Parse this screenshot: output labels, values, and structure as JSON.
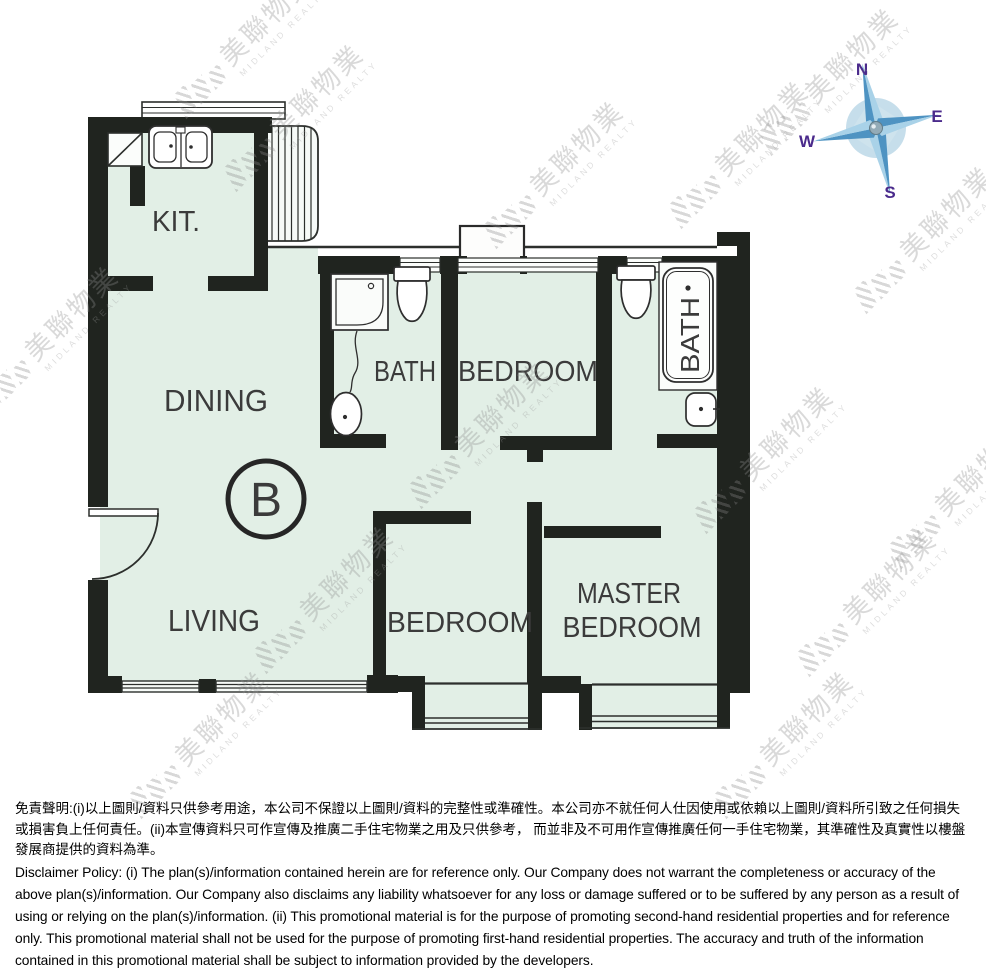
{
  "plan": {
    "unit_label": "B",
    "rooms": {
      "kitchen": "KIT.",
      "dining": "DINING",
      "living": "LIVING",
      "bath": "BATH",
      "bedroom": "BEDROOM",
      "ensuite_bath": "BATH",
      "bedroom2": "BEDROOM",
      "master_line1": "MASTER",
      "master_line2": "BEDROOM"
    }
  },
  "compass": {
    "north": "N",
    "east": "E",
    "south": "S",
    "west": "W"
  },
  "watermark": {
    "cn": "美聯物業",
    "en": "MIDLAND REALTY"
  },
  "colors": {
    "wall": "#20241f",
    "floor": "#e2efe6",
    "compass_blue": "#7db4d8",
    "compass_letter": "#4b2b8c"
  },
  "disclaimer": {
    "zh": "免責聲明:(i)以上圖則/資料只供參考用途，本公司不保證以上圖則/資料的完整性或準確性。本公司亦不就任何人仕因使用或依賴以上圖則/資料所引致之任何損失或損害負上任何責任。(ii)本宣傳資料只可作宣傳及推廣二手住宅物業之用及只供參考， 而並非及不可用作宣傳推廣任何一手住宅物業，其準確性及真實性以樓盤發展商提供的資料為準。",
    "en": "Disclaimer Policy: (i) The plan(s)/information contained herein are for reference only. Our Company does not warrant the completeness or accuracy of the above plan(s)/information. Our Company also disclaims any liability whatsoever for any loss or damage suffered or to be suffered by any person as a result of using or relying on the plan(s)/information. (ii) This promotional material is for the purpose of promoting second-hand residential properties and for reference only. This promotional material shall not be used for the purpose of promoting first-hand residential properties. The accuracy and truth of the information contained in this promotional material shall be subject to information provided by the developers."
  }
}
